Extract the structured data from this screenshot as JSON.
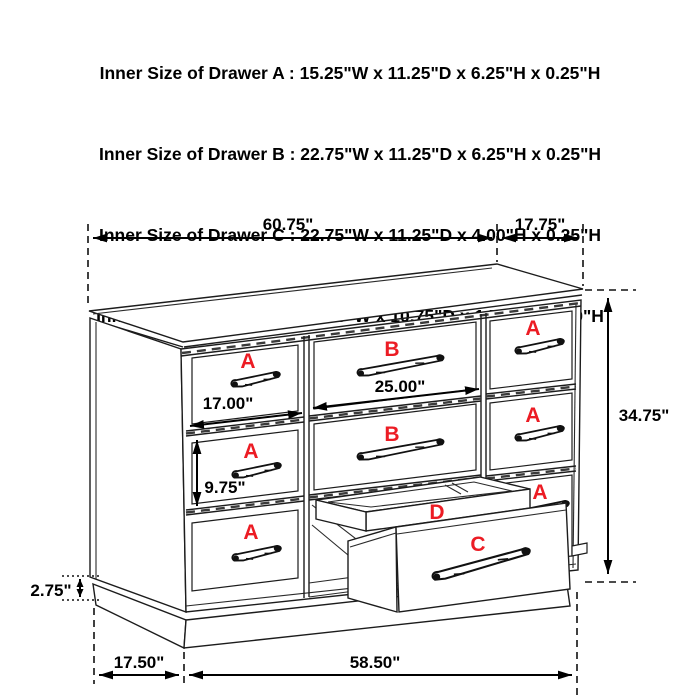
{
  "header": {
    "lines": [
      "Inner Size of Drawer A : 15.25\"W x 11.25\"D x 6.25\"H x 0.25\"H",
      "Inner Size of Drawer B : 22.75\"W x 11.25\"D x 6.25\"H x 0.25\"H",
      "Inner Size of Drawer C : 22.75\"W x 11.25\"D x 4.00\"H x 0.25\"H",
      "Inner Size of Drawer  D : 22.50\"W x 10.75\"D x 1.75\"H x 0.50\"H"
    ]
  },
  "labels": {
    "a": "A",
    "b": "B",
    "c": "C",
    "d": "D"
  },
  "dimensions": {
    "top_width": "60.75\"",
    "top_depth": "17.75\"",
    "height": "34.75\"",
    "drawer_a_width": "17.00\"",
    "drawer_b_width": "25.00\"",
    "drawer_a_height": "9.75\"",
    "base_height": "2.75\"",
    "bottom_depth": "17.50\"",
    "bottom_width": "58.50\""
  },
  "icons": {
    "drawer_handle": "bar-pull-handle"
  },
  "colors": {
    "label": "#ec1c24",
    "line": "#1c1c1c",
    "dim_text": "#000000"
  }
}
